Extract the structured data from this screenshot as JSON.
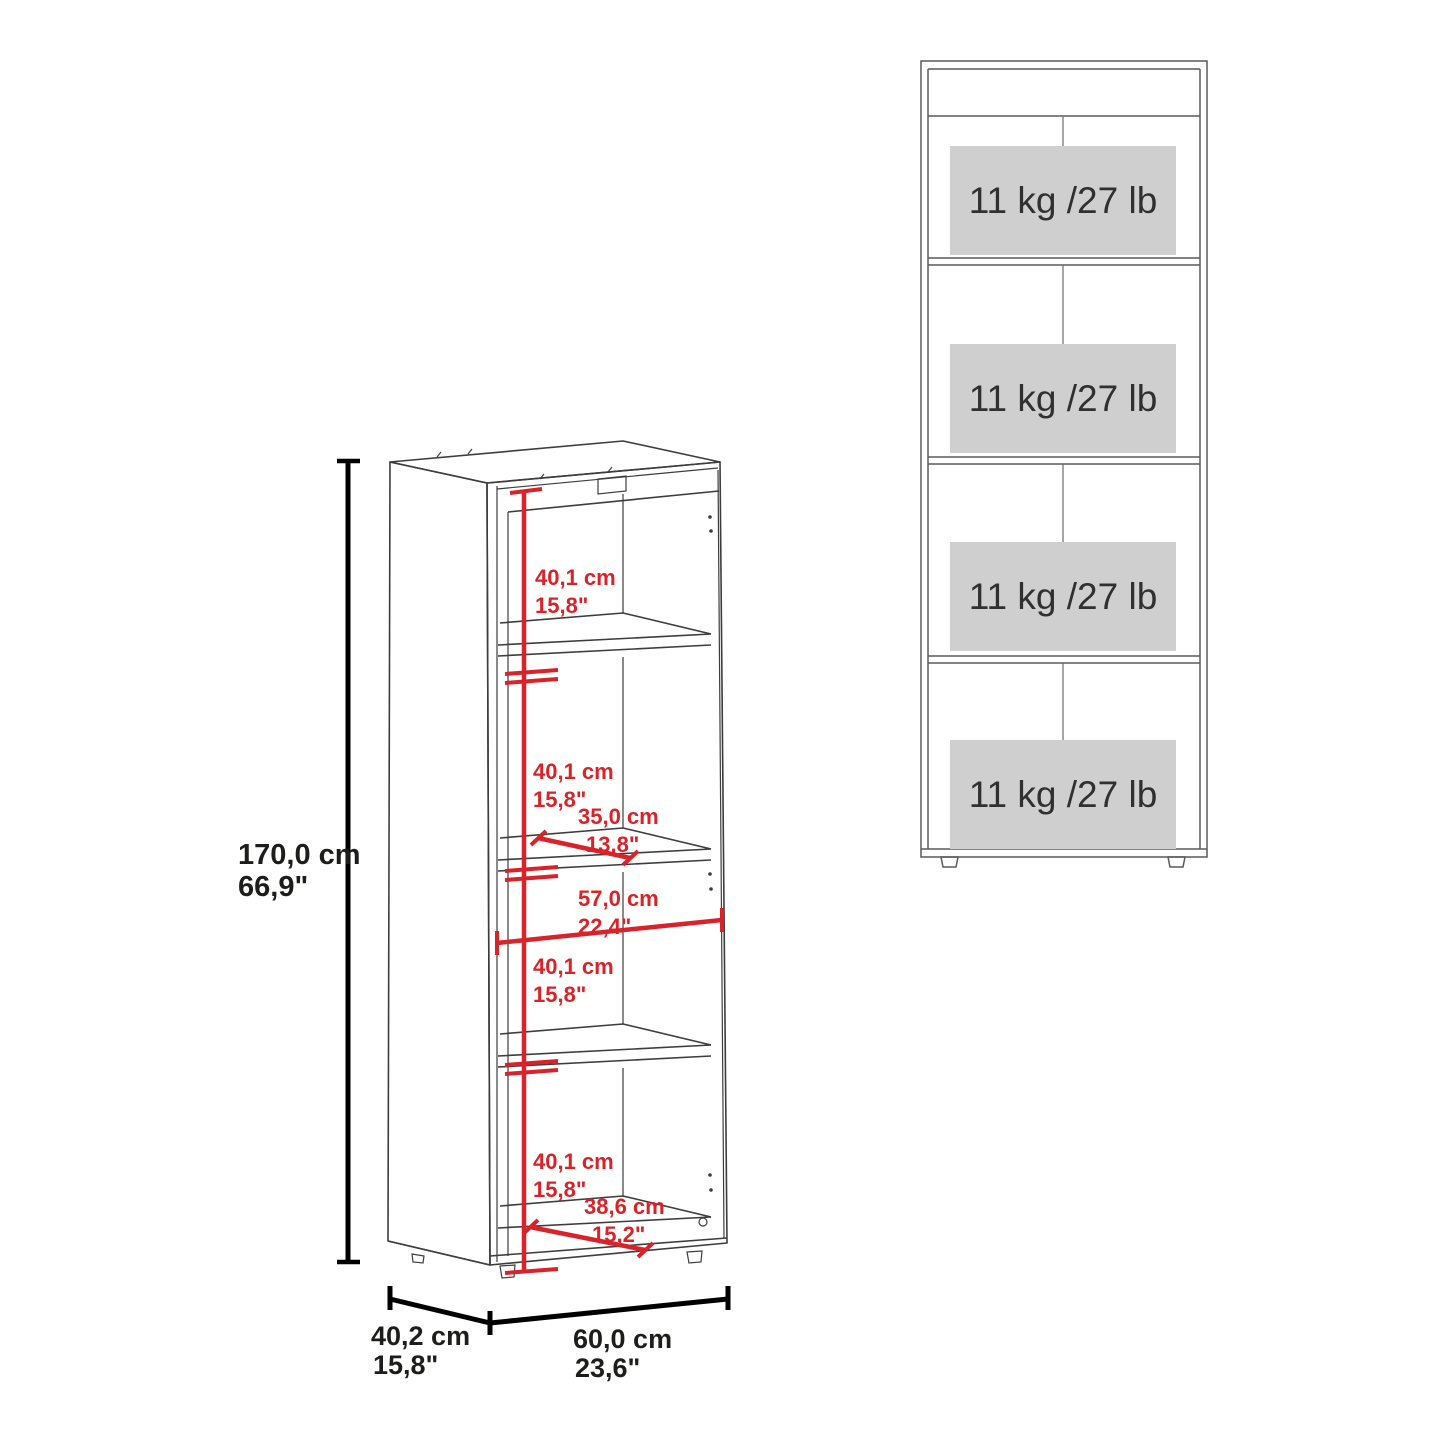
{
  "colors": {
    "dimension_red": "#d9222a",
    "line_dark": "#3d3d3d",
    "line_front_view": "#5a5a5a",
    "dimension_black": "#000000",
    "load_box_bg": "#cfcfcf",
    "load_box_text": "#303030",
    "background": "#ffffff"
  },
  "perspective_view": {
    "overall_height": {
      "cm": "170,0 cm",
      "inch": "66,9\""
    },
    "overall_depth": {
      "cm": "40,2 cm",
      "inch": "15,8\""
    },
    "overall_width": {
      "cm": "60,0 cm",
      "inch": "23,6\""
    },
    "compartment_heights": [
      {
        "cm": "40,1 cm",
        "inch": "15,8\""
      },
      {
        "cm": "40,1 cm",
        "inch": "15,8\""
      },
      {
        "cm": "40,1 cm",
        "inch": "15,8\""
      },
      {
        "cm": "40,1 cm",
        "inch": "15,8\""
      }
    ],
    "shelf_depth": {
      "cm": "35,0 cm",
      "inch": "13,8\""
    },
    "interior_width": {
      "cm": "57,0 cm",
      "inch": "22,4\""
    },
    "base_depth": {
      "cm": "38,6 cm",
      "inch": "15,2\""
    }
  },
  "front_view": {
    "shelf_load_capacities": [
      "11 kg /27 lb",
      "11 kg /27 lb",
      "11 kg /27 lb",
      "11 kg /27 lb"
    ]
  }
}
